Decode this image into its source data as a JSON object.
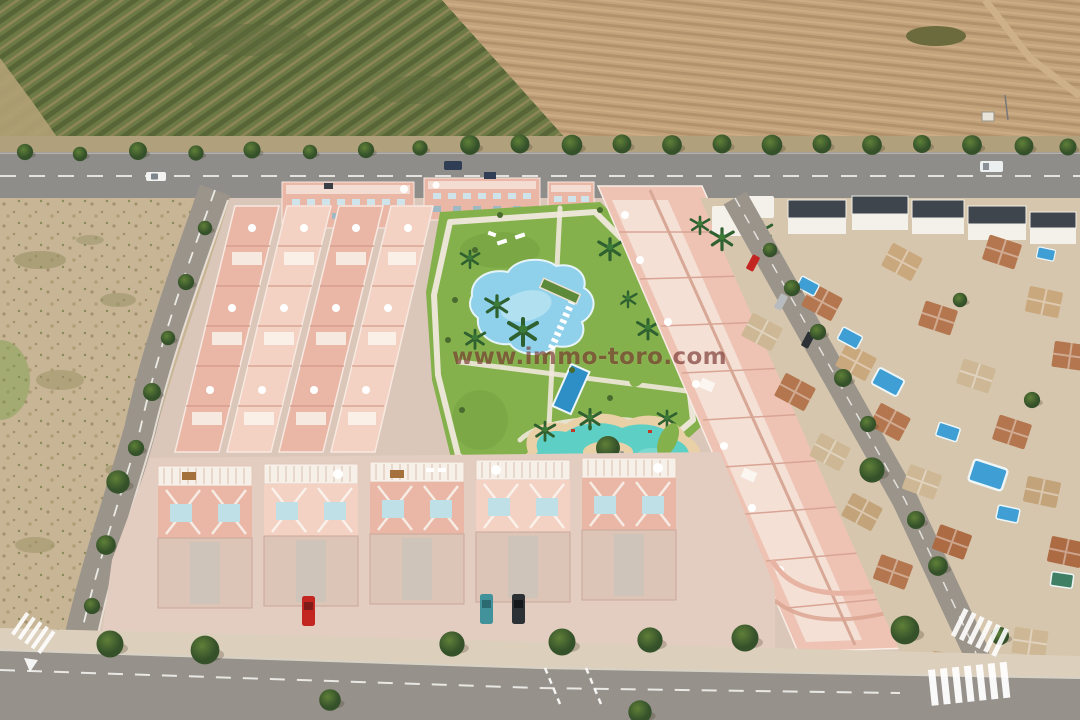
{
  "watermark": {
    "text": "www.immo-toro.com",
    "color": "#6E2621",
    "opacity": 0.62
  },
  "scene": {
    "description": "aerial-3d-render-of-new-residential-development",
    "regions": [
      "orchard-field",
      "plowed-field",
      "tree-lined-road",
      "vacant-lot",
      "townhouse-complex",
      "central-park",
      "community-pools",
      "lagoon-pool",
      "linear-apartment-block",
      "existing-villa-district",
      "perimeter-streets",
      "bottom-road"
    ],
    "community_pool_count": 3,
    "villa_pool_count": 8
  },
  "palette": {
    "orchard_base": "#6d7a45",
    "orchard_row": "#576537",
    "orchard_soil": "#9d8f63",
    "field_base": "#c2a27a",
    "field_furrow": "#b2926c",
    "road": "#8e8d8a",
    "road_line": "#f2f2ee",
    "tree": "#47632f",
    "lot": "#c7b595",
    "lot_speckle": "#a3906c",
    "pavement": "#dac7ba",
    "pavement_light": "#e7d6cb",
    "bldg_pink": "#eab7a7",
    "bldg_pink_light": "#f3d2c4",
    "bldg_pink_dark": "#d99e8e",
    "white_trim": "#f8f4ee",
    "lawn": "#85b14c",
    "lawn_dark": "#6f9c3f",
    "pool_blue": "#8fd0ea",
    "pool_deep": "#2e8fc7",
    "lagoon": "#5ecfc5",
    "sand": "#ead0a6",
    "villa_ground": "#d6c6ad",
    "villa_wall": "#f3f1ea",
    "roof_terracotta": "#b4764e",
    "roof_pale": "#cdb794",
    "roof_dark": "#3e454d",
    "street": "#9b948b",
    "bottom_road": "#96918a"
  },
  "vehicles": {
    "red": "#c32521",
    "white": "#f2f2f0",
    "teal": "#41929a",
    "dark": "#2c3136",
    "silver": "#b8bbbd",
    "van_blue": "#2f3e55"
  }
}
